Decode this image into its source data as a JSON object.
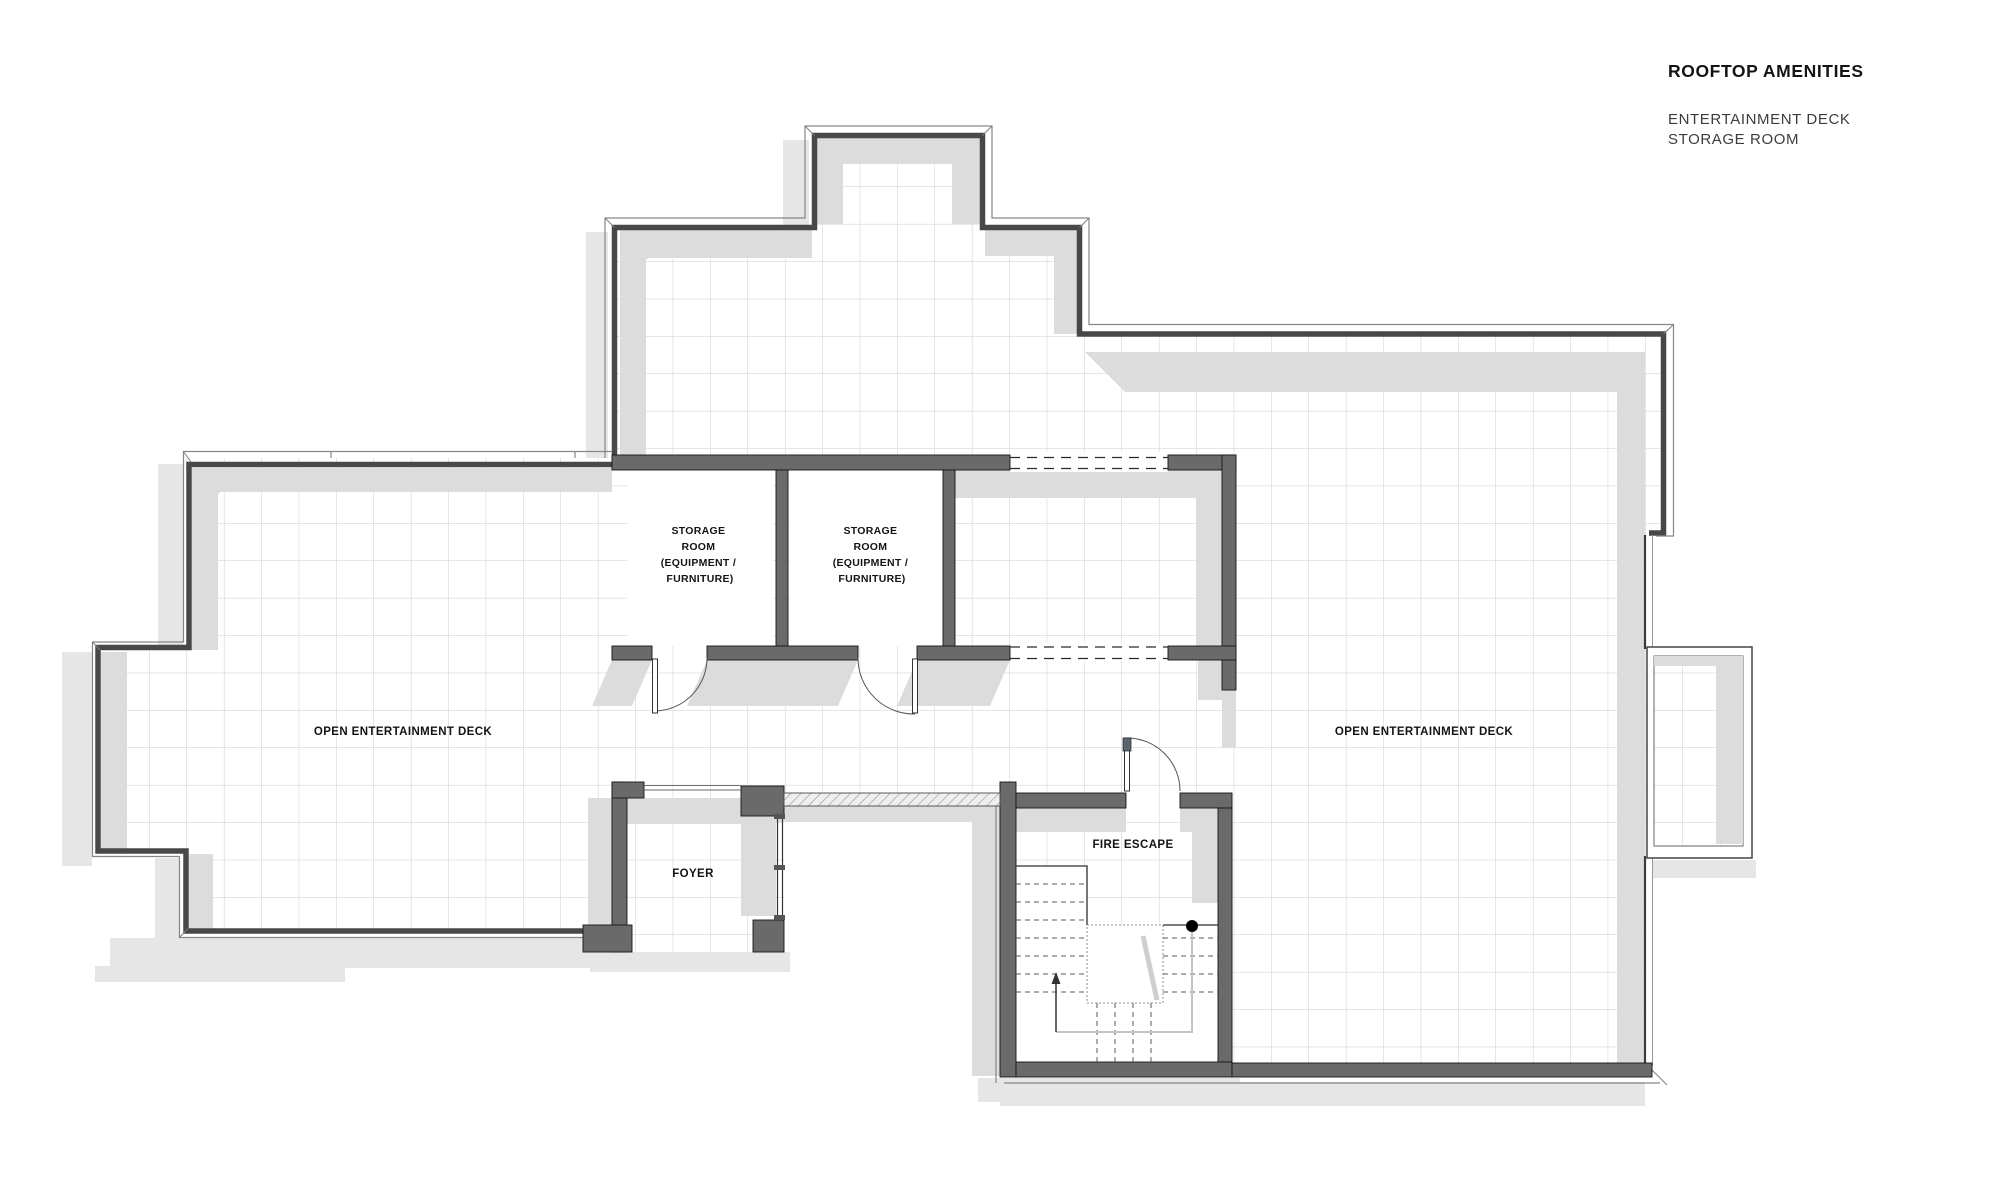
{
  "header": {
    "title": "ROOFTOP AMENITIES",
    "subtitle_line1": "ENTERTAINMENT DECK",
    "subtitle_line2": "STORAGE ROOM"
  },
  "plan": {
    "labels": {
      "deck_left": "OPEN ENTERTAINMENT DECK",
      "deck_right": "OPEN ENTERTAINMENT DECK",
      "foyer": "FOYER",
      "fire_escape": "FIRE ESCAPE",
      "storage_lines": [
        "STORAGE",
        "ROOM",
        "(EQUIPMENT /",
        "FURNITURE)"
      ]
    },
    "colors": {
      "background": "#ffffff",
      "wall": "#6a6a6a",
      "wall_dark": "#484848",
      "shadow_inner": "#dcdcdc",
      "shadow_outer": "#e6e6e6",
      "grid_line": "#c9ccd1",
      "text": "#141414",
      "subtitle": "#3c3c3c"
    }
  }
}
